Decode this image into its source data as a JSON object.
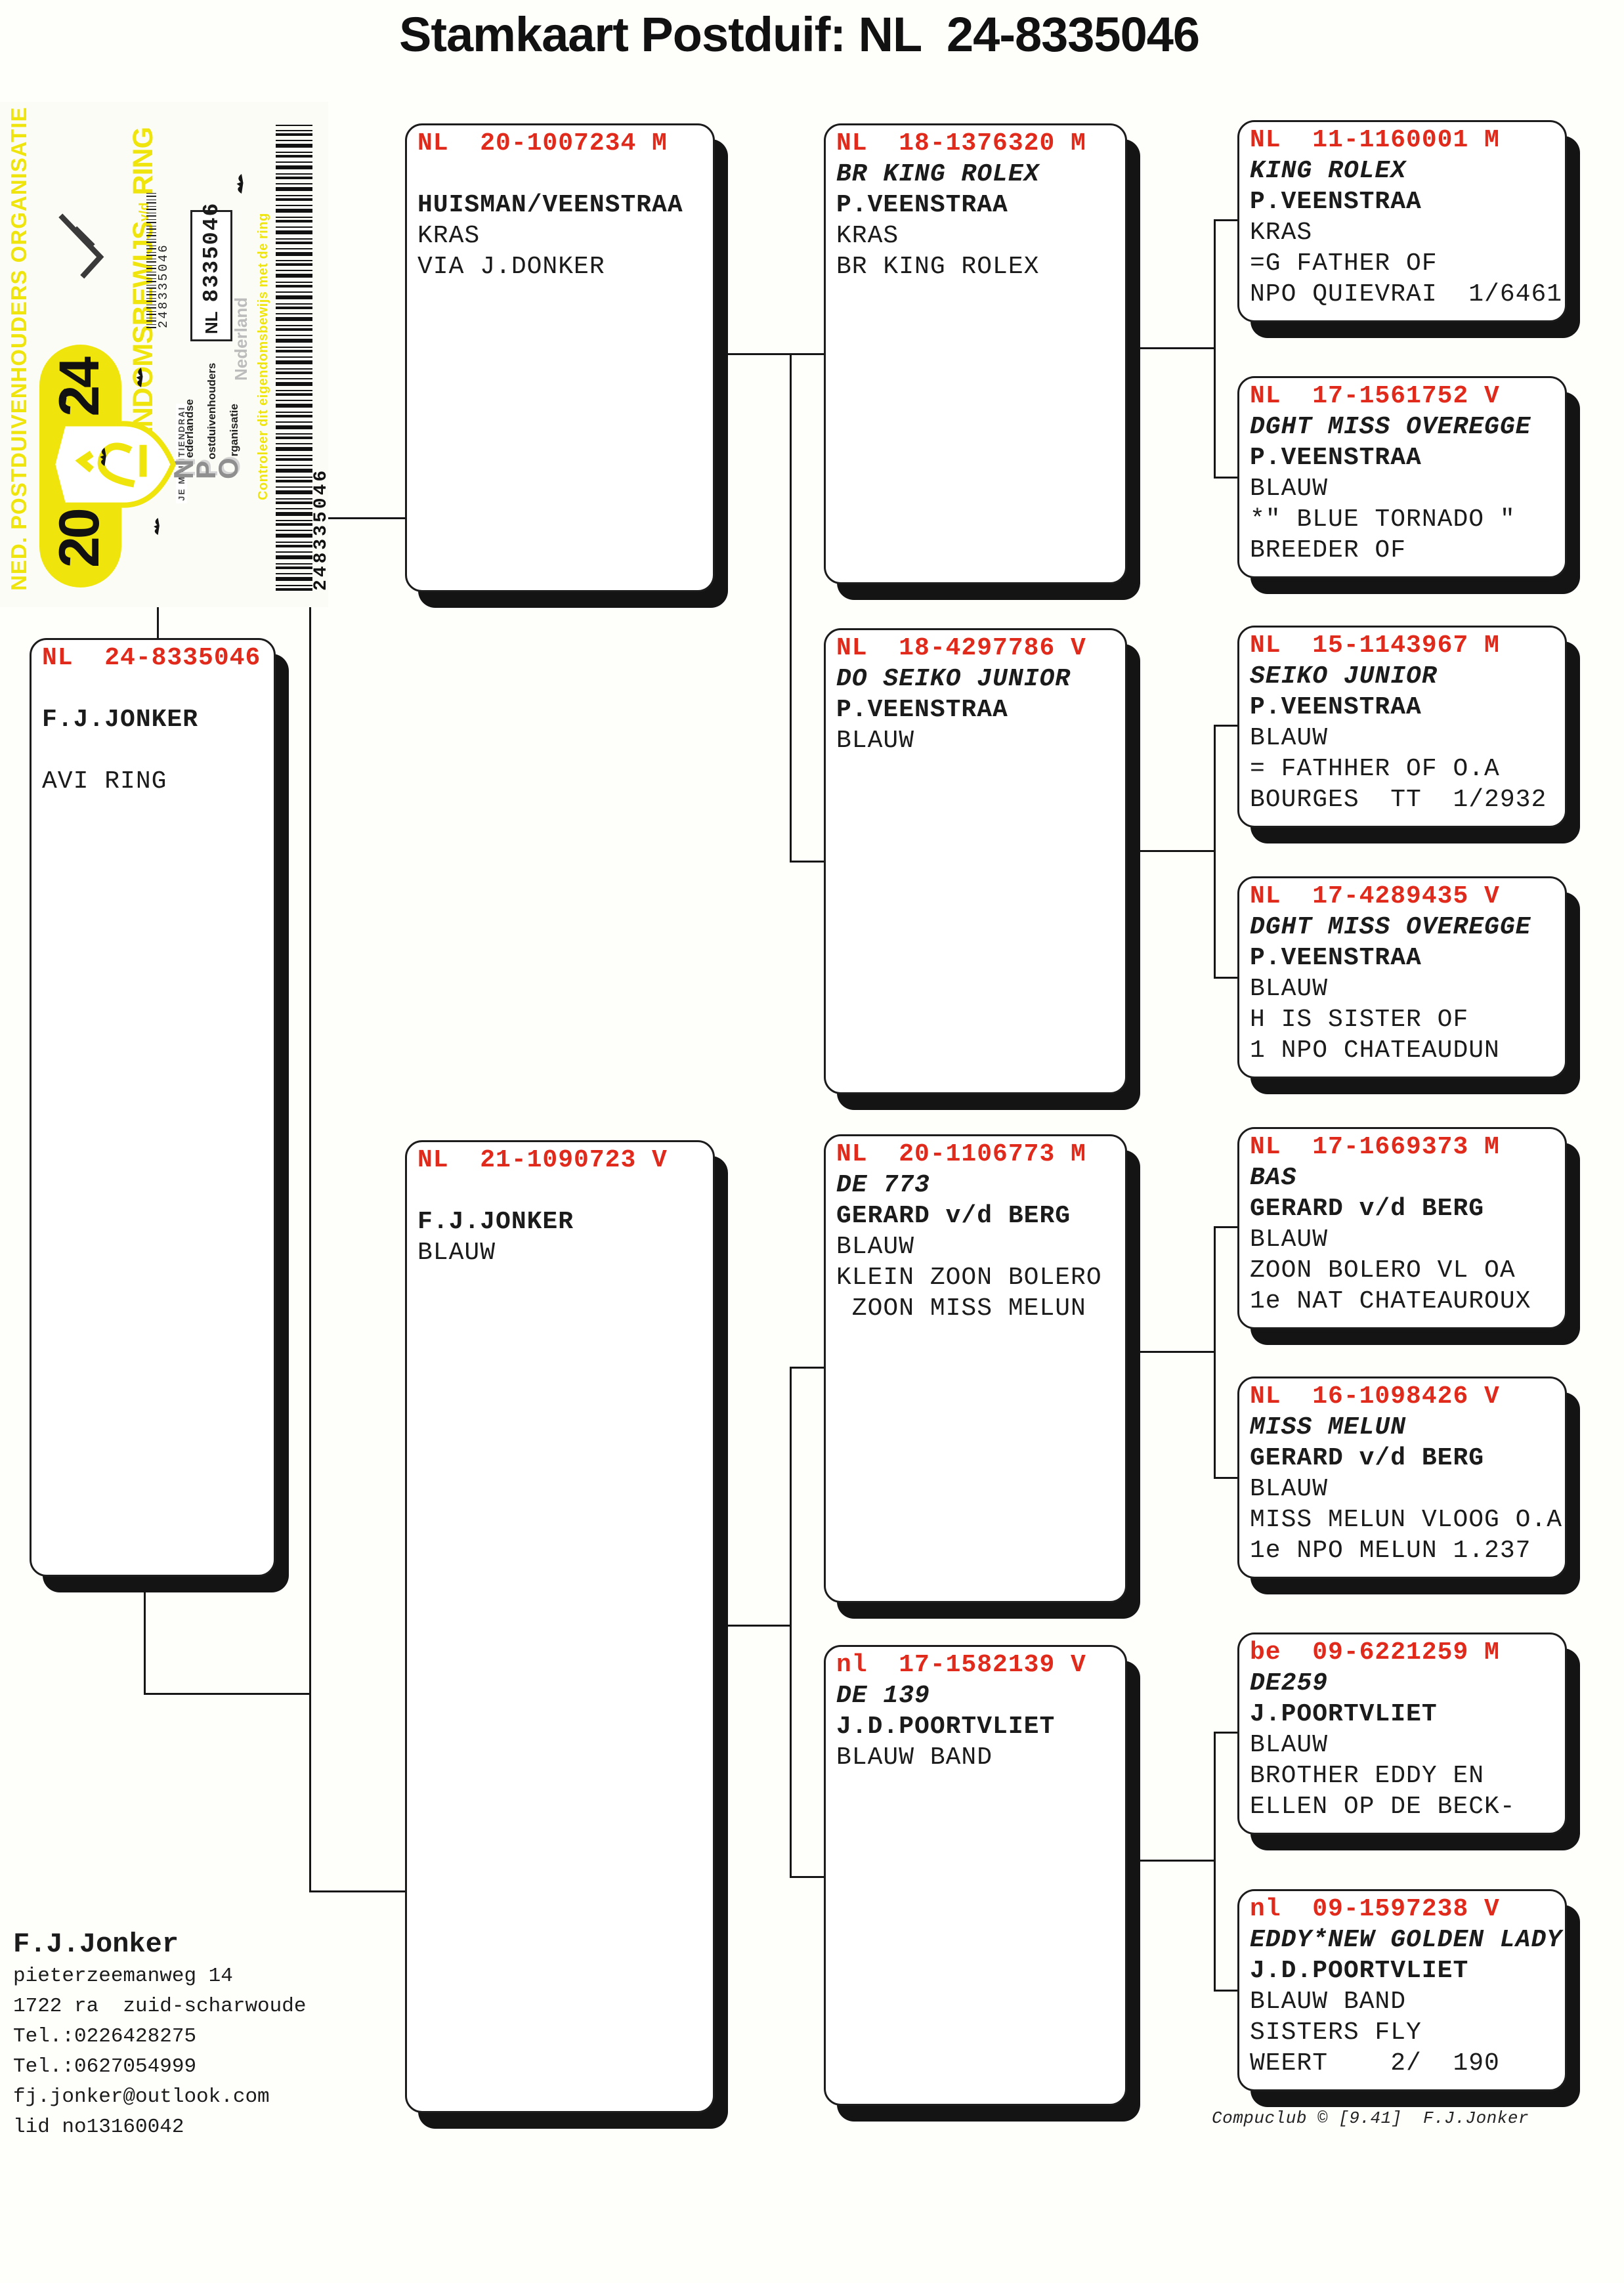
{
  "title": "Stamkaart Postduif: NL  24-8335046",
  "colors": {
    "accent_red": "#e02a1c",
    "sticker_yellow": "#efe50c"
  },
  "sticker": {
    "org_line": "NED. POSTDUIVENHOUDERS ORGANISATIE",
    "year_left": "20",
    "year_right": "24",
    "motto": "JE MAINTIENDRAI",
    "ownership_word": "EIGENDOMSBEWIJS",
    "ownership_vd": "v/d",
    "ownership_ring": "RING",
    "npo": [
      {
        "initial": "N",
        "rest": "ederlandse"
      },
      {
        "initial": "P",
        "rest": "ostduivenhouders"
      },
      {
        "initial": "O",
        "rest": "rganisatie"
      }
    ],
    "ring_country": "NL",
    "ring_number": "8335046",
    "nederland": "Nederland",
    "controleer": "Controleer dit eigendomsbewijs met de ring",
    "barcode_number": "248335046"
  },
  "pedigree": {
    "subject": {
      "ring": "NL  24-8335046",
      "name": "",
      "owner": "F.J.JONKER",
      "color": "",
      "note1": "AVI RING",
      "note2": ""
    },
    "father": {
      "ring": "NL  20-1007234 M",
      "name": "",
      "owner": "HUISMAN/VEENSTRAA",
      "color": "KRAS",
      "note1": "VIA J.DONKER",
      "note2": ""
    },
    "mother": {
      "ring": "NL  21-1090723 V",
      "name": "",
      "owner": "F.J.JONKER",
      "color": "BLAUW",
      "note1": "",
      "note2": ""
    },
    "ff": {
      "ring": "NL  18-1376320 M",
      "name": "BR KING ROLEX",
      "owner": "P.VEENSTRAA",
      "color": "KRAS",
      "note1": "BR KING ROLEX",
      "note2": ""
    },
    "fm": {
      "ring": "NL  18-4297786 V",
      "name": "DO SEIKO JUNIOR",
      "owner": "P.VEENSTRAA",
      "color": "BLAUW",
      "note1": "",
      "note2": ""
    },
    "mf": {
      "ring": "NL  20-1106773 M",
      "name": "DE 773",
      "owner": "GERARD v/d BERG",
      "color": "BLAUW",
      "note1": "KLEIN ZOON BOLERO",
      "note2": " ZOON MISS MELUN"
    },
    "mm": {
      "ring": "nl  17-1582139 V",
      "name": "DE 139",
      "owner": "J.D.POORTVLIET",
      "color": "BLAUW BAND",
      "note1": "",
      "note2": ""
    },
    "fff": {
      "ring": "NL  11-1160001 M",
      "name": "KING ROLEX",
      "owner": "P.VEENSTRAA",
      "color": "KRAS",
      "note1": "=G FATHER OF",
      "note2": "NPO QUIEVRAI  1/6461"
    },
    "ffm": {
      "ring": "NL  17-1561752 V",
      "name": "DGHT MISS OVEREGGE",
      "owner": "P.VEENSTRAA",
      "color": "BLAUW",
      "note1": "*\" BLUE TORNADO \"",
      "note2": "BREEDER OF"
    },
    "fmf": {
      "ring": "NL  15-1143967 M",
      "name": "SEIKO JUNIOR",
      "owner": "P.VEENSTRAA",
      "color": "BLAUW",
      "note1": "= FATHHER OF O.A",
      "note2": "BOURGES  TT  1/2932"
    },
    "fmm": {
      "ring": "NL  17-4289435 V",
      "name": "DGHT MISS OVEREGGE",
      "owner": "P.VEENSTRAA",
      "color": "BLAUW",
      "note1": "H IS SISTER OF",
      "note2": "1 NPO CHATEAUDUN"
    },
    "mff": {
      "ring": "NL  17-1669373 M",
      "name": "BAS",
      "owner": "GERARD v/d BERG",
      "color": "BLAUW",
      "note1": "ZOON BOLERO VL OA",
      "note2": "1e NAT CHATEAUROUX"
    },
    "mfm": {
      "ring": "NL  16-1098426 V",
      "name": "MISS MELUN",
      "owner": "GERARD v/d BERG",
      "color": "BLAUW",
      "note1": "MISS MELUN VLOOG O.A",
      "note2": "1e NPO MELUN 1.237"
    },
    "mmf": {
      "ring": "be  09-6221259 M",
      "name": "DE259",
      "owner": "J.POORTVLIET",
      "color": "BLAUW",
      "note1": "BROTHER EDDY EN",
      "note2": "ELLEN OP DE BECK-"
    },
    "mmm": {
      "ring": "nl  09-1597238 V",
      "name": "EDDY*NEW GOLDEN LADY",
      "owner": "J.D.POORTVLIET",
      "color": "BLAUW BAND",
      "note1": "SISTERS FLY",
      "note2": "WEERT    2/  190"
    }
  },
  "contact": {
    "name": "F.J.Jonker",
    "lines": [
      "pieterzeemanweg 14",
      "1722 ra  zuid-scharwoude",
      "Tel.:0226428275",
      "Tel.:0627054999",
      "fj.jonker@outlook.com",
      "lid no13160042"
    ]
  },
  "footer": "Compuclub © [9.41]  F.J.Jonker"
}
